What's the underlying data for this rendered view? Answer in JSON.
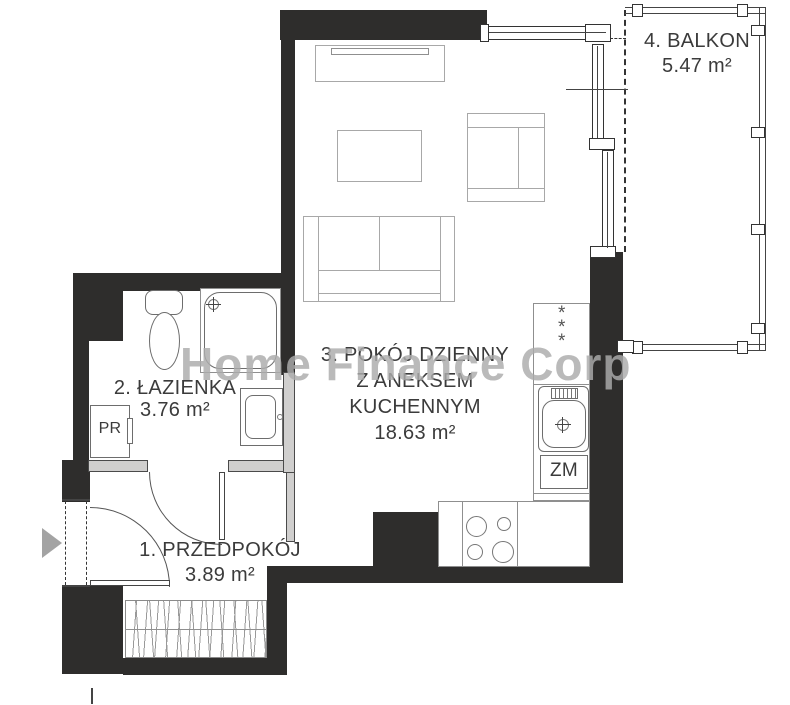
{
  "watermark": "Home Finance Corp",
  "rooms": {
    "hall": {
      "name": "1. PRZEDPOKÓJ",
      "area": "3.89 m²"
    },
    "bath": {
      "name": "2. ŁAZIENKA",
      "area": "3.76 m²"
    },
    "living": {
      "name_line1": "3. POKÓJ DZIENNY",
      "name_line2": "Z ANEKSEM",
      "name_line3": "KUCHENNYM",
      "area": "18.63 m²"
    },
    "balcony": {
      "name": "4. BALKON",
      "area": "5.47 m²"
    }
  },
  "appliances": {
    "washing_machine": "PR",
    "dishwasher": "ZM",
    "fridge_star": "*"
  },
  "colors": {
    "wall": "#2e2d2c",
    "partition": "#d0cfce",
    "watermark": "#acacac"
  }
}
